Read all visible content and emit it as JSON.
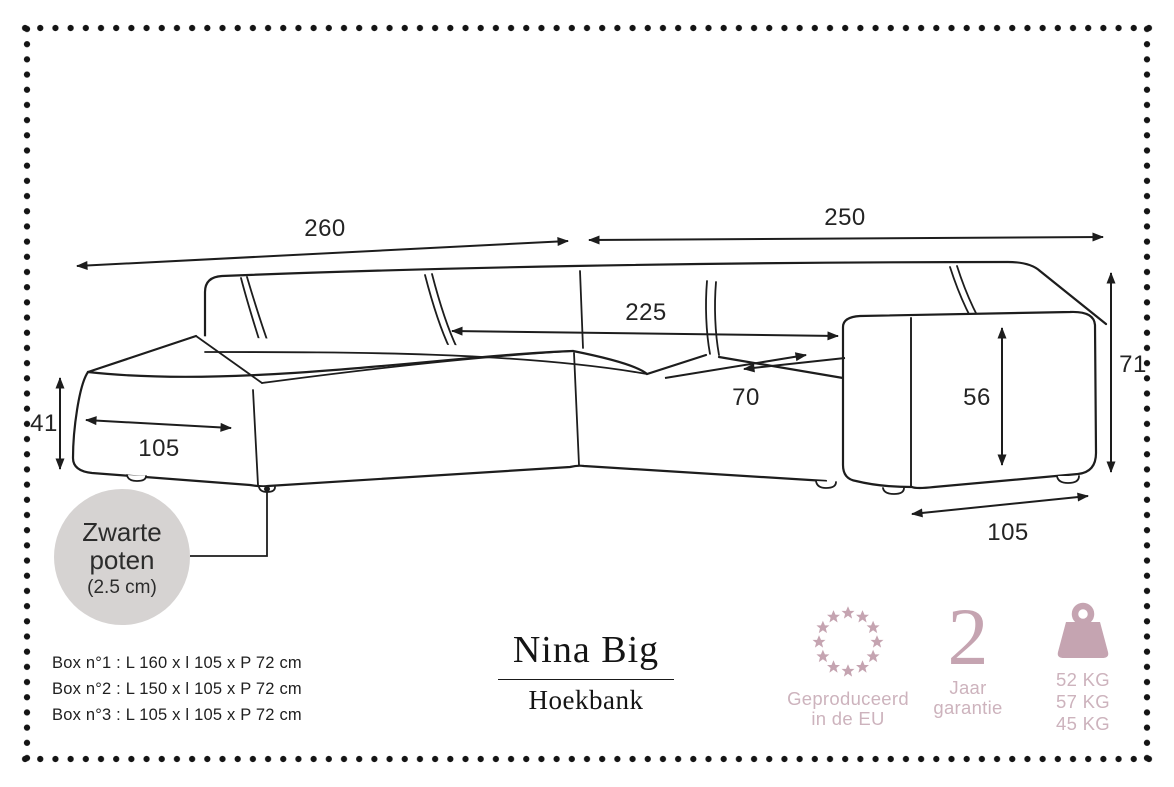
{
  "colors": {
    "line": "#1d1d1d",
    "accent": "#c5a4b1",
    "accent_light": "#cdb3bd",
    "note_circle": "#d6d3d2"
  },
  "sofa": {
    "dimensions": {
      "chaise_side_length": "260",
      "front_length": "250",
      "inner_length": "225",
      "seat_depth": "70",
      "armrest_height": "56",
      "total_height": "71",
      "seat_height": "41",
      "chaise_width": "105",
      "armrest_depth": "105"
    },
    "legs_note": {
      "line1": "Zwarte",
      "line2": "poten",
      "size": "(2.5 cm)"
    }
  },
  "boxes": [
    {
      "label": "Box n°1 : L 160 x l 105 x P 72 cm"
    },
    {
      "label": "Box n°2 : L 150 x l 105 x P 72 cm"
    },
    {
      "label": "Box n°3 : L 105 x l 105 x P 72 cm"
    }
  ],
  "product": {
    "name": "Nina Big",
    "type": "Hoekbank"
  },
  "badges": {
    "made_in": {
      "line1": "Geproduceerd",
      "line2": "in de EU"
    },
    "warranty": {
      "value": "2",
      "line1": "Jaar",
      "line2": "garantie"
    },
    "weights": [
      {
        "label": "52 KG"
      },
      {
        "label": "57 KG"
      },
      {
        "label": "45 KG"
      }
    ]
  }
}
